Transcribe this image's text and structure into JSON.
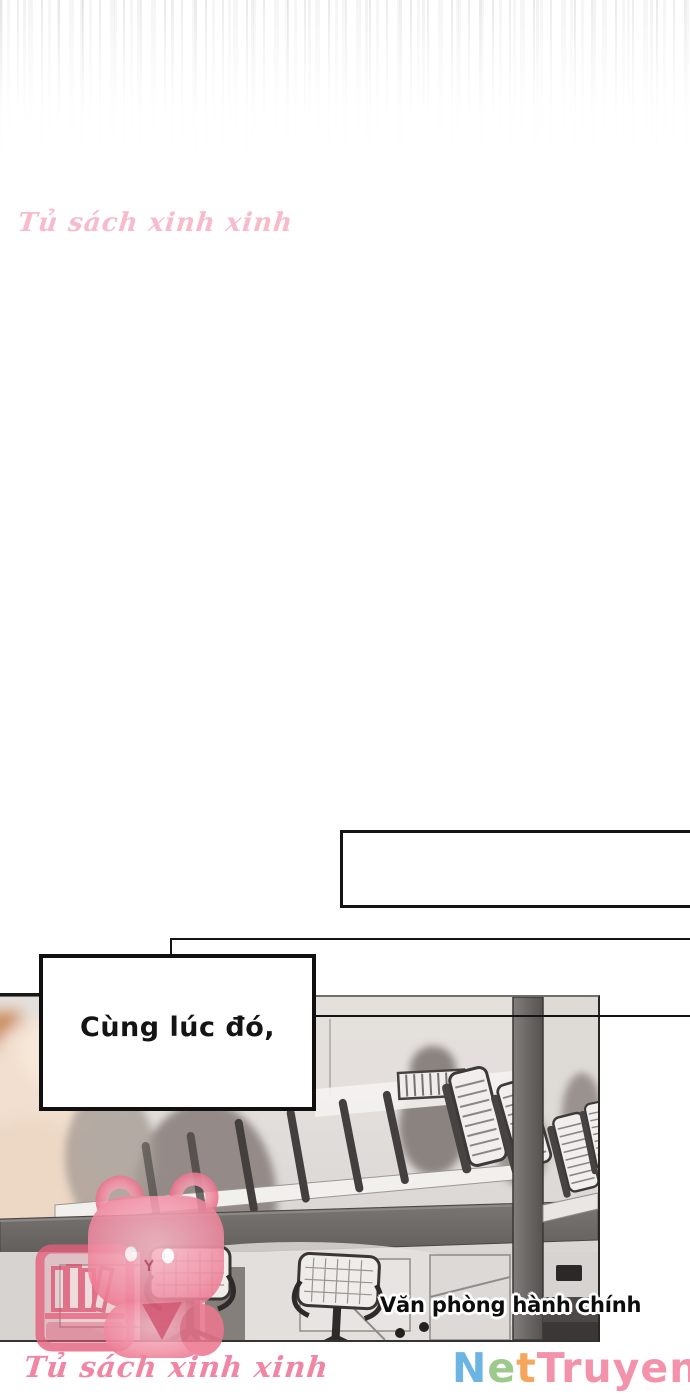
{
  "caption_box": {
    "text": "Cùng lúc đó,"
  },
  "scene_label": {
    "text": "Văn phòng hành chính"
  },
  "watermark": {
    "top_text": "Tủ sách xinh xinh",
    "bottom_text": "Tủ sách xinh xinh",
    "color": "#ee7f9e"
  },
  "site_logo": {
    "name": "NetTruyen",
    "letters": [
      {
        "char": "N",
        "color": "#6cb4e4"
      },
      {
        "char": "e",
        "color": "#9dca8c"
      },
      {
        "char": "t",
        "color": "#f3a65c"
      },
      {
        "char": "T",
        "color": "#f392aa"
      },
      {
        "char": "r",
        "color": "#f392aa"
      },
      {
        "char": "u",
        "color": "#f392aa"
      },
      {
        "char": "y",
        "color": "#f392aa"
      },
      {
        "char": "e",
        "color": "#f392aa"
      },
      {
        "char": "n",
        "color": "#f392aa"
      }
    ]
  }
}
